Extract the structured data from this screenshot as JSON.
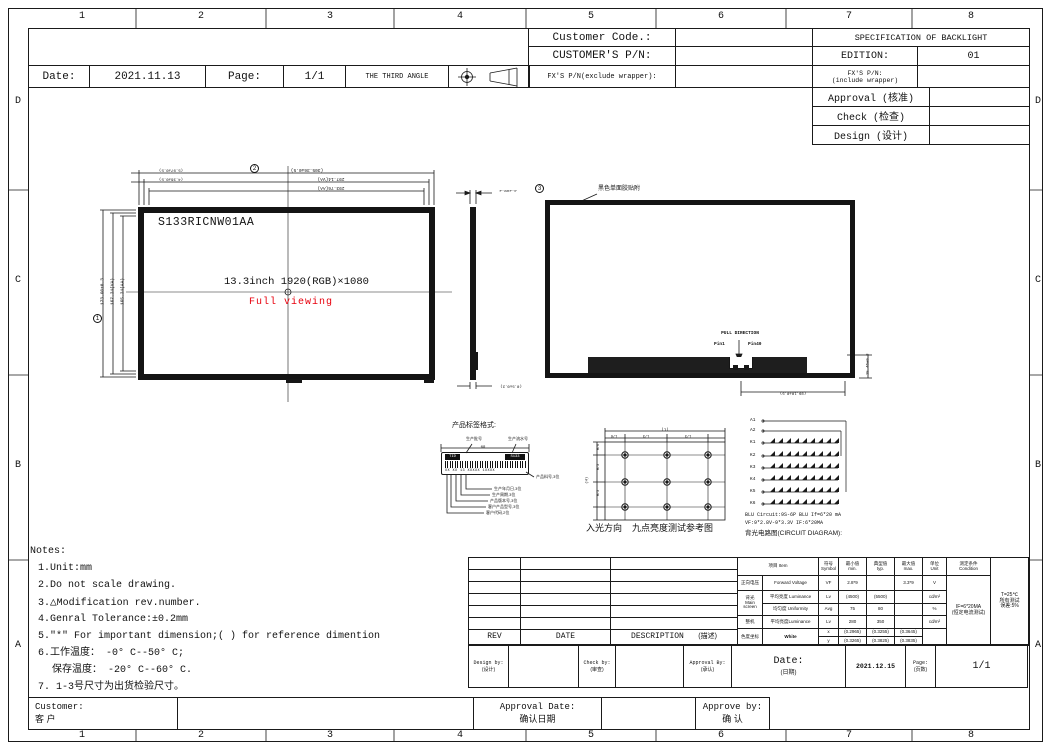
{
  "frame": {
    "cols": [
      "1",
      "2",
      "3",
      "4",
      "5",
      "6",
      "7",
      "8"
    ],
    "rows": [
      "D",
      "C",
      "B",
      "A"
    ]
  },
  "title_block": {
    "customer_code_label": "Customer Code.:",
    "customer_pn_label": "CUSTOMER'S P/N:",
    "fx_pn_exclude_label": "FX'S P/N(exclude wrapper):",
    "spec_title": "SPECIFICATION OF BACKLIGHT",
    "edition_label": "EDITION:",
    "edition_value": "01",
    "fx_pn_include_label": "FX'S P/N:",
    "fx_pn_include_sub": "(include wrapper)",
    "approval_label": "Approval (核准)",
    "check_label": "Check (检查)",
    "design_label": "Design (设计)",
    "date_label": "Date:",
    "date_value": "2021.11.13",
    "page_label": "Page:",
    "page_value": "1/1",
    "third_angle_label": "THE THIRD ANGLE"
  },
  "front_view": {
    "model": "S133RICNW01AA",
    "size_resolution": "13.3inch 1920(RGB)×1080",
    "full_viewing": "Full viewing",
    "dim_width_outline": "(305.36±0.5)",
    "dim_width_va": "297.14(VA)",
    "dim_width_aa": "293.76(AA)",
    "dim_offset1": "(5.97±0.5)",
    "dim_offset2": "(4.36±0.5)",
    "dim_height_outline": "173.60±0.3",
    "dim_height_va": "167.24(VA)",
    "dim_height_aa": "165.24(AA)",
    "balloon1": "1",
    "balloon2": "2"
  },
  "side_view": {
    "dim_thickness": "3.2±0.2",
    "balloon3": "3",
    "dim_bottom": "(0.5±0.2)"
  },
  "rear_view": {
    "tape_callout": "黑色单面胶贴附",
    "pull_direction": "PULL DIRECTION",
    "pin1": "Pin1",
    "pin40": "Pin40",
    "dim_connector_width": "(89.10±0.5)",
    "dim_connector_height": "15.46±0.3"
  },
  "label_spec": {
    "title": "产品标签格式:",
    "dim_width": "89",
    "tid": "TID",
    "model_code": "S133",
    "serial_row": "XX XX 13 XXXXX  1XXXX",
    "callout_batch": "生产批号",
    "callout_serial": "生产流水号",
    "callout_part": "产品料号,3位",
    "callout_date": "生产年月日,3位",
    "callout_week": "生产周期,3位",
    "callout_version": "产品版本号,3位",
    "callout_customer_model": "客户产品型号,3位",
    "callout_customer_code": "客户代码,2位"
  },
  "nine_point": {
    "caption_dir": "入光方向",
    "caption": "九点亮度测试参考图",
    "dim_l": "(L)",
    "dim_l6": "L/6",
    "dim_l3a": "L/3",
    "dim_l3b": "L/3",
    "dim_h": "(H)",
    "dim_h6": "H/6",
    "dim_h3a": "H/3",
    "dim_h3b": "H/3"
  },
  "circuit": {
    "a1": "A1",
    "a2": "A2",
    "k1": "K1",
    "k2": "K2",
    "k3": "K3",
    "k4": "K4",
    "k5": "K5",
    "k6": "K6",
    "spec_line1": "BLU Circuit:9S-6P BLU If=6*20 mA",
    "spec_line2": "VF:9*2.8V-9*3.3V IF:6*20MA",
    "diagram_title": "背光电路图(CIRCUIT DIAGRAM):"
  },
  "notes": {
    "title": "Notes:",
    "n1": "1.Unit:mm",
    "n2": "2.Do not scale drawing.",
    "n3a": "3.",
    "n3_icon": "△",
    "n3b": "Modification rev.number.",
    "n4": "4.Genral Tolerance:±0.2mm",
    "n5": "5.\"*\" For important dimension;( ) for reference dimention",
    "n6": "6.工作温度：  -0° C--50° C;",
    "n7": "保存温度：  -20° C--60° C.",
    "n8": "7. 1-3号尺寸为出货检验尺寸。"
  },
  "rev_table": {
    "rev": "REV",
    "date": "DATE",
    "description": "DESCRIPTION",
    "description_cn": "(描述)"
  },
  "spec_table": {
    "h_item_cn": "项目",
    "h_item_en": "Item",
    "h_symbol_cn": "符号",
    "h_symbol_en": "Symbol",
    "h_min_cn": "最小值",
    "h_min_en": "min.",
    "h_typ_cn": "典型值",
    "h_typ_en": "typ.",
    "h_max_cn": "最大值",
    "h_max_en": "max.",
    "h_unit_cn": "单位",
    "h_unit_en": "Unit",
    "h_cond_cn": "测定条件",
    "h_cond_en": "Condition",
    "fv_cn": "正向电压",
    "fv_en": "Forward Voltage",
    "fv_sym": "VF",
    "fv_min": "2.8*9",
    "fv_max": "3.3*9",
    "fv_unit": "V",
    "bl_cn1": "背光",
    "bl_cn2": "Main screen",
    "lum_en": "平均亮度 Luminance",
    "lum_sym": "Lv",
    "lum_min": "(4500)",
    "lum_typ": "(5500)",
    "lum_unit": "cd/m²",
    "uni_en": "均匀度 Uniformity",
    "uni_sym": "Avg",
    "uni_min": "75",
    "uni_typ": "80",
    "uni_unit": "%",
    "mach_cn": "整机",
    "mach_en": "平均亮度Luminance",
    "mach_sym": "Lv",
    "mach_min": "280",
    "mach_typ": "350",
    "mach_unit": "cd/m²",
    "chroma_cn": "色度坐标",
    "chroma_en": "White",
    "x_sym": "x",
    "x_min": "(0.2965)",
    "x_typ": "(0.3255)",
    "x_max": "(0.3645)",
    "y_sym": "y",
    "y_min": "(0.3265)",
    "y_typ": "(0.3825)",
    "y_max": "(0.3835)",
    "cond_line1": "IF=6*20MA",
    "cond_line2": "(恒定电流测试)",
    "tol_line1": "T=25℃",
    "tol_line2": "所有测试",
    "tol_line3": "误差:5%"
  },
  "signoff": {
    "design_label": "Design by:",
    "design_cn": "(设计)",
    "check_label": "Check by:",
    "check_cn": "(审查)",
    "approval_label": "Approval By:",
    "approval_cn": "(承认)",
    "date_label": "Date:",
    "date_cn": "(日期)",
    "date_value": "2021.12.15",
    "page_label": "Page:",
    "page_cn": "(页数)",
    "page_value": "1/1"
  },
  "footer": {
    "customer_label": "Customer:",
    "customer_cn": "客 户",
    "approval_date_label": "Approval Date:",
    "approval_date_cn": "确认日期",
    "approve_by_label": "Approve by:",
    "approve_by_cn": "确 认"
  }
}
